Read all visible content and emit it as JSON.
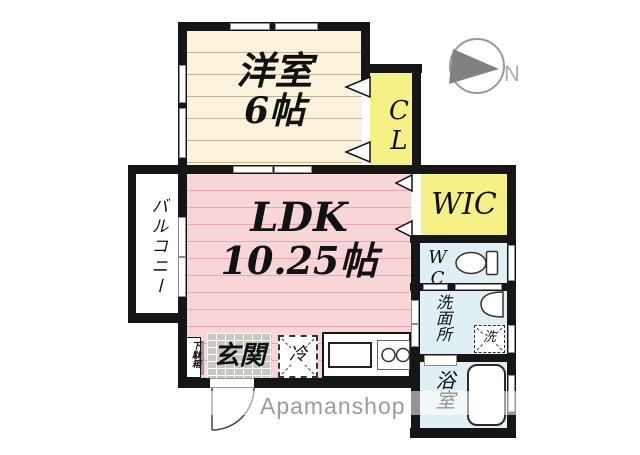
{
  "plan": {
    "western_room": {
      "label": "洋室",
      "size": "6帖"
    },
    "ldk": {
      "label": "LDK",
      "size": "10.25帖"
    },
    "balcony": {
      "label": "バルコニー"
    },
    "closet": {
      "label": "CL"
    },
    "wic": {
      "label": "WIC"
    },
    "toilet_room": {
      "label": "WC"
    },
    "washroom": {
      "label": "洗面所"
    },
    "washing_machine": {
      "label": "洗"
    },
    "bathroom": {
      "label": "浴室"
    },
    "entrance": {
      "label": "玄関"
    },
    "refrigerator": {
      "label": "冷"
    },
    "shoe_cabinet": {
      "label": "下駄箱"
    }
  },
  "compass": {
    "label": "N"
  },
  "watermark": {
    "label": "Apamanshop"
  },
  "colors": {
    "wall": "#161616",
    "western_room_floor": "#FAF2DB",
    "ldk_floor": "#F8D6D8",
    "closet_fill": "#F5F187",
    "wet_area_fill": "#DFEFF4",
    "tile_fill": "#C8C8C0",
    "door_window_outline": "#8C8C8C",
    "watermark_gray": "#9B9B9B"
  }
}
